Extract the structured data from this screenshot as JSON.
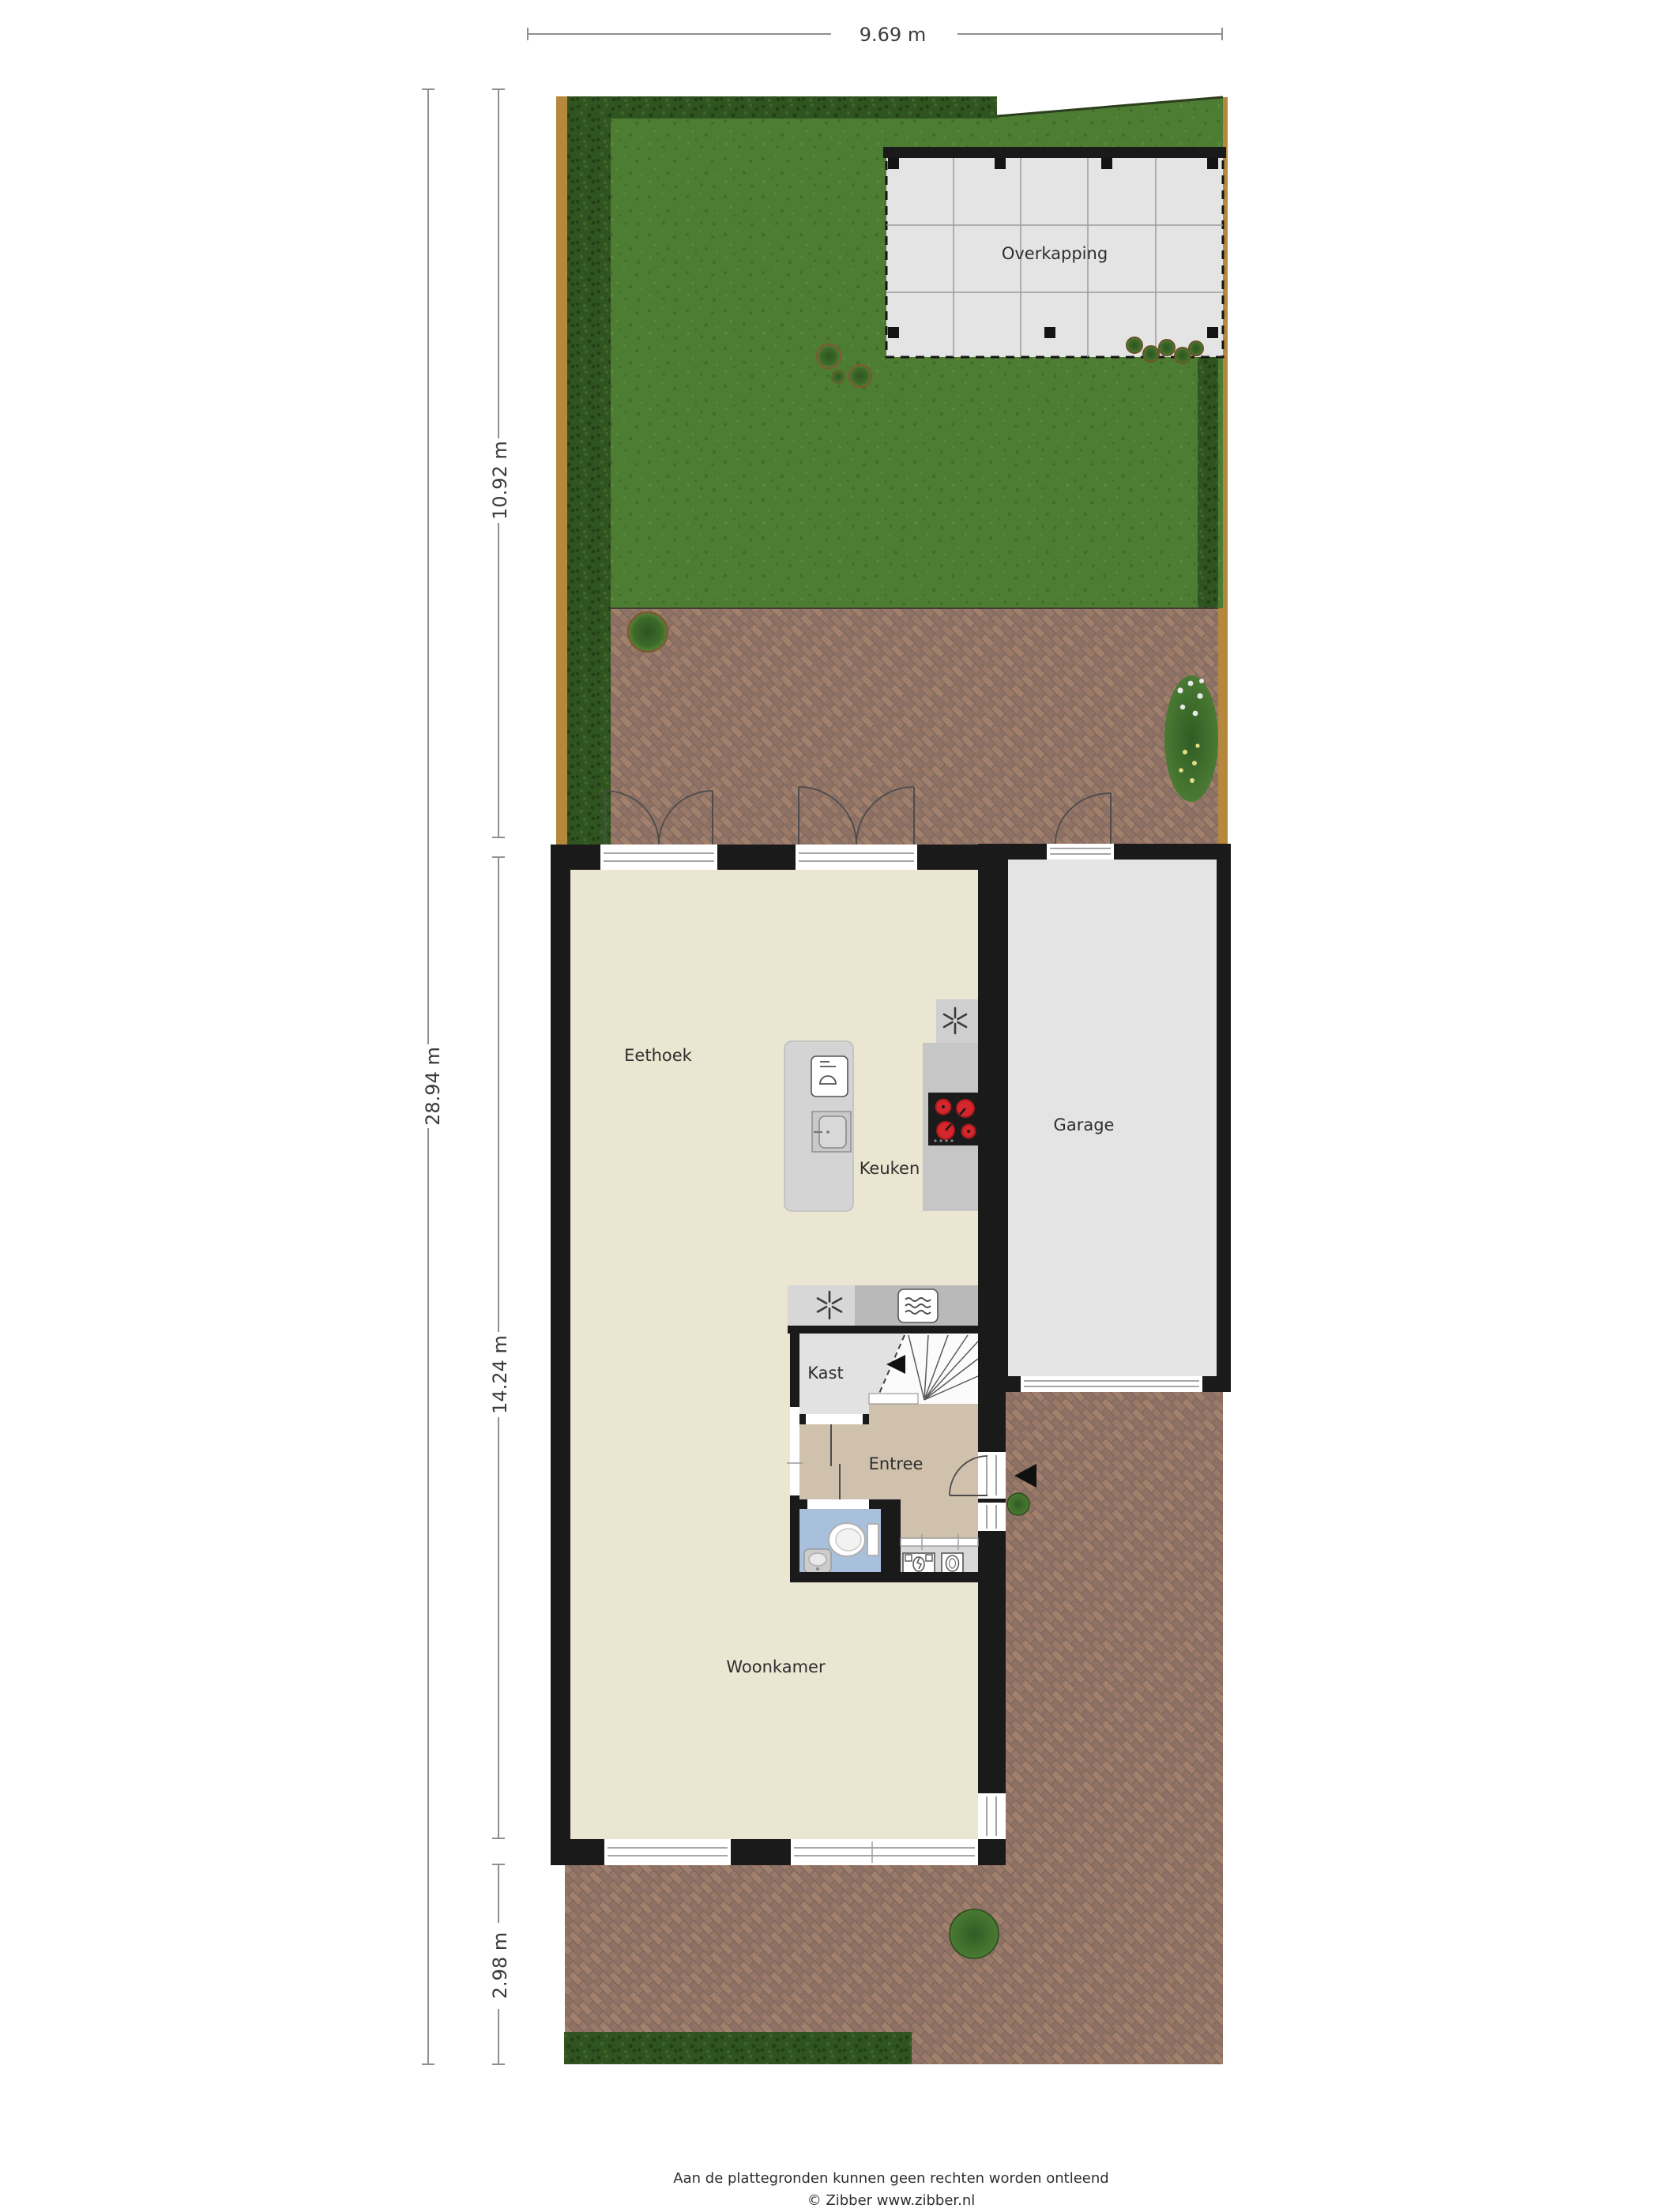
{
  "rooms": {
    "overkapping": "Overkapping",
    "eethoek": "Eethoek",
    "keuken": "Keuken",
    "garage": "Garage",
    "kast": "Kast",
    "entree": "Entree",
    "woonkamer": "Woonkamer"
  },
  "dimensions": {
    "width_top": "9.69 m",
    "total_left": "28.94 m",
    "garden_depth": "10.92 m",
    "house_depth": "14.24 m",
    "front_depth": "2.98 m"
  },
  "footer": {
    "disclaimer": "Aan de plattegronden kunnen geen rechten worden ontleend",
    "credit": "© Zibber www.zibber.nl"
  },
  "colors": {
    "grass": "#4d7c33",
    "grass-dark": "#426c29",
    "grass-light": "#578a3a",
    "hedge": "#305420",
    "hedge-dark": "#243f16",
    "hedge-light": "#3c662b",
    "fence": "#b5883e",
    "brick": "#9b7968",
    "brick-alt": "#8f7265",
    "brick-warm": "#a3806c",
    "brick-gap": "#7f6a5e",
    "wall": "#1a1a1a",
    "floor-main": "#ebe6d1",
    "floor-garage": "#e4e4e4",
    "floor-kast": "#e2e2e2",
    "floor-entree": "#cfc1ac",
    "floor-toilet": "#a9c0dc",
    "floor-utility": "#d9d9d9",
    "counter": "#c6c6c6",
    "counter-light": "#d7d7d7",
    "island": "#d4d4d4",
    "canopy": "#e4e4e4",
    "hob": "#1b1b1b",
    "burner": "#d4262b",
    "dim-line": "#8f8f8f",
    "label-text": "#2e2e2e",
    "frame-line": "#8a8a8a"
  }
}
